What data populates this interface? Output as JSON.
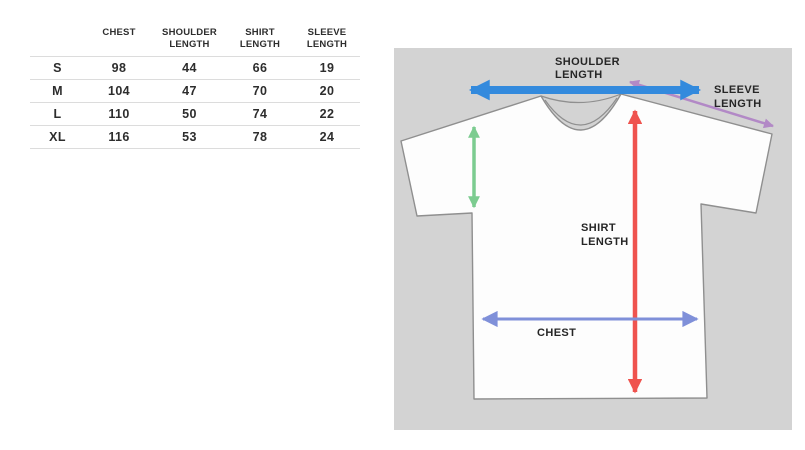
{
  "size_chart": {
    "columns": [
      "",
      "CHEST",
      "SHOULDER LENGTH",
      "SHIRT LENGTH",
      "SLEEVE LENGTH"
    ],
    "rows": [
      {
        "size": "S",
        "chest": 98,
        "shoulder_length": 44,
        "shirt_length": 66,
        "sleeve_length": 19
      },
      {
        "size": "M",
        "chest": 104,
        "shoulder_length": 47,
        "shirt_length": 70,
        "sleeve_length": 20
      },
      {
        "size": "L",
        "chest": 110,
        "shoulder_length": 50,
        "shirt_length": 74,
        "sleeve_length": 22
      },
      {
        "size": "XL",
        "chest": 116,
        "shoulder_length": 53,
        "shirt_length": 78,
        "sleeve_length": 24
      }
    ]
  },
  "diagram": {
    "labels": {
      "shoulder": {
        "line1": "SHOULDER",
        "line2": "LENGTH"
      },
      "sleeve": {
        "line1": "SLEEVE",
        "line2": "LENGTH"
      },
      "shirt": {
        "line1": "SHIRT",
        "line2": "LENGTH"
      },
      "chest": {
        "line1": "CHEST"
      }
    },
    "colors": {
      "panel_background": "#d3d3d3",
      "shoulder_arrow": "#338add",
      "sleeve_arrow": "#b289c6",
      "armhole_arrow": "#7ccc90",
      "shirt_length_arrow": "#ef534e",
      "chest_arrow": "#7f90d9",
      "shirt_fill": "#fdfdfd",
      "shirt_outline": "#8f8f8f"
    }
  }
}
